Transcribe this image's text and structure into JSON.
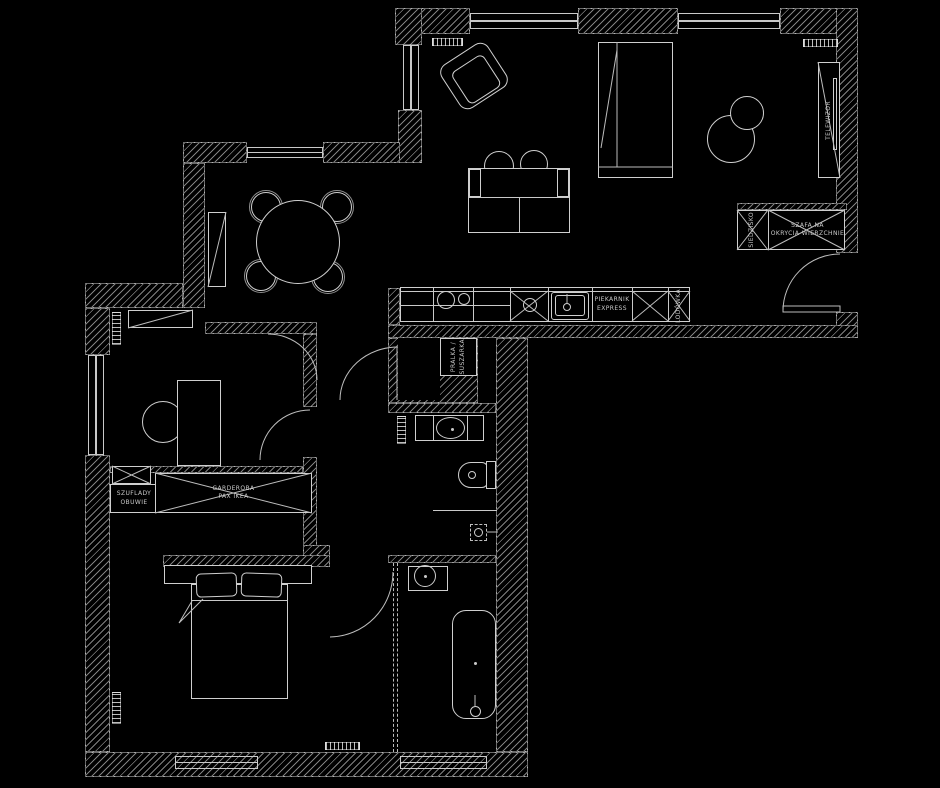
{
  "colors": {
    "background": "#000000",
    "line": "#cfcfcf",
    "hatch": "#8f8f8f",
    "text": "#c8c8c8"
  },
  "labels": {
    "tv": "TELEWIZOR",
    "coat_wardrobe_line1": "SZAFA NA",
    "coat_wardrobe_line2": "OKRYCIA WIERZCHNIE",
    "seat": "SIEDZISKO",
    "oven_line1": "PIEKARNIK",
    "oven_line2": "EXPRESS",
    "fridge": "LODÓWKA",
    "washer_line1": "PRALKA /",
    "washer_line2": "SUSZARKA",
    "shoe_line1": "SZUFLADY",
    "shoe_line2": "OBUWIE",
    "pax_line1": "GARDEROBA",
    "pax_line2": "PAX IKEA"
  }
}
